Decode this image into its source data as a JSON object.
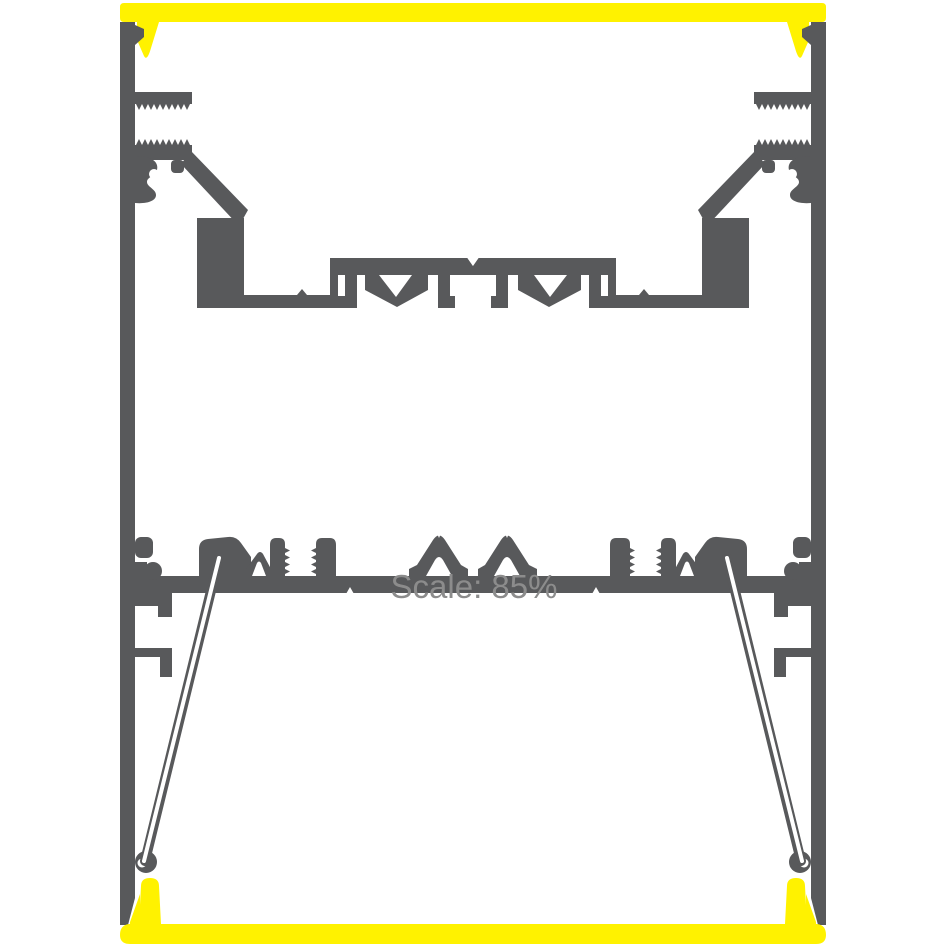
{
  "drawing": {
    "watermark_text": "Scale: 85%"
  },
  "colors": {
    "profile_gray": "#58595B",
    "diffuser_yellow": "#FFF200",
    "watermark_gray": "#8C8C8C",
    "background": "#FFFFFF"
  }
}
